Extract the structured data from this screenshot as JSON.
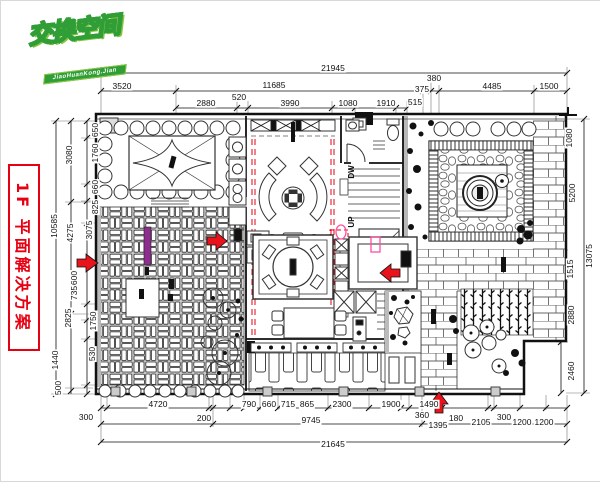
{
  "logo": {
    "title": "交换空间",
    "subtitle": "JiaoHuanKong.Jian",
    "brand_green": "#2f9e36"
  },
  "side_label": {
    "text": "1F 平面解决方案",
    "color": "#e60012"
  },
  "plan_labels": {
    "down": "DW",
    "up": "UP"
  },
  "colors": {
    "beam_red": "#e60012",
    "arrow_red": "#e8131b",
    "marker_pink": "#ff4fa0",
    "feature_purple": "#8d2d8d"
  },
  "dims": {
    "top_overall": "21945",
    "top_row2": [
      "3520",
      "11685",
      "375",
      "380",
      "4485",
      "1500"
    ],
    "top_row3": [
      "2880",
      "520",
      "3990",
      "1080",
      "1910",
      "515"
    ],
    "bottom_row1": [
      "300",
      "4720",
      "200",
      "790",
      "660",
      "715",
      "865",
      "2300",
      "1900",
      "1490"
    ],
    "bottom_row2": [
      "9745",
      "360",
      "1395",
      "180",
      "2105",
      "300",
      "1200",
      "1200"
    ],
    "bottom_overall": "21645",
    "left_outer": "10585",
    "left_middle": [
      "3080",
      "4275",
      "2825",
      "1440"
    ],
    "left_inner": [
      "650",
      "1760",
      "660",
      "825",
      "3075",
      "600",
      "735",
      "1750",
      "530",
      "500"
    ],
    "right_inner": [
      "1080",
      "5200",
      "1515",
      "2880",
      "2460"
    ],
    "right_outer": "13075"
  }
}
